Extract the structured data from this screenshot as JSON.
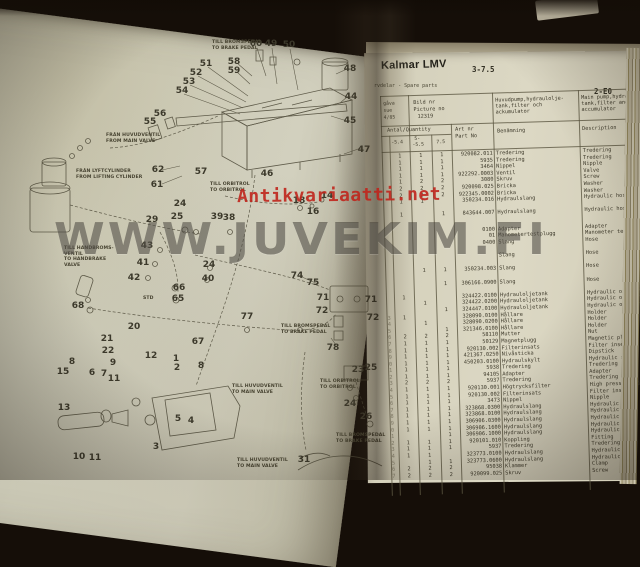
{
  "photo": {
    "watermark": "WWW.JUVEKIM.FI",
    "stamp": "Antikvariaatti.net"
  },
  "colors": {
    "stamp_red": "#c0251c",
    "watermark_gray": "rgba(60,55,48,0.52)",
    "paper_left": "#cccab7",
    "paper_right": "#dcd8c4",
    "table_line": "#5b5641",
    "ink": "#3e3a2b"
  },
  "right_page": {
    "brand": "Kalmar LMV",
    "model_range": "3-7.5",
    "section_code": "2-E0",
    "subtitle": "rvdelar - Spare parts",
    "issue": {
      "l1": "gåva",
      "l2": "sue",
      "l3": "4/85"
    },
    "picture": {
      "l1": "Bild nr",
      "l2": "Picture no",
      "l3": "12319"
    },
    "title_sv": {
      "l1": "Huvudpump,hydraulolje-",
      "l2": "tank,filter och",
      "l3": "ackumulator"
    },
    "title_en": {
      "l1": "Main pump,hydraulic oil-",
      "l2": "tank,filter and",
      "l3": "accumulator"
    },
    "columns": {
      "qty": "Antal/Quantity",
      "sub1": "-5.4",
      "sub2a": "5-",
      "sub2b": "-5.5",
      "sub3": "7.5",
      "part1": "Art nr",
      "part2": "Part No",
      "name": "Benämning",
      "desc": "Description"
    },
    "rows": [
      {
        "pos": "",
        "q1": "1",
        "q2": "1",
        "q3": "1",
        "part": "920082.011",
        "name": "Tredering",
        "desc": "Tredering",
        "gap": 0
      },
      {
        "pos": "",
        "q1": "1",
        "q2": "1",
        "q3": "1",
        "part": "5935",
        "name": "Tredering",
        "desc": "Tredering",
        "gap": 0
      },
      {
        "pos": "",
        "q1": "1",
        "q2": "1",
        "q3": "1",
        "part": "3464",
        "name": "Nippel",
        "desc": "Nipple",
        "gap": 0
      },
      {
        "pos": "",
        "q1": "1",
        "q2": "1",
        "q3": "1",
        "part": "922292.0003",
        "name": "Ventil",
        "desc": "Valve",
        "gap": 0
      },
      {
        "pos": "",
        "q1": "1",
        "q2": "2",
        "q3": "2",
        "part": "3080",
        "name": "Skruv",
        "desc": "Screw",
        "gap": 0
      },
      {
        "pos": "",
        "q1": "2",
        "q2": "2",
        "q3": "2",
        "part": "920098.025",
        "name": "Bricka",
        "desc": "Washer",
        "gap": 0
      },
      {
        "pos": "",
        "q1": "2",
        "q2": "2",
        "q3": "2",
        "part": "922345.0002",
        "name": "Bricka",
        "desc": "Washer",
        "gap": 0
      },
      {
        "pos": "",
        "q1": "1",
        "q2": "1",
        "q3": "",
        "part": "350234.016",
        "name": "Hydraulslang",
        "desc": "Hydraulic hose",
        "gap": 0
      },
      {
        "pos": "",
        "q1": "1",
        "q2": "",
        "q3": "1",
        "part": "843644.007",
        "name": "Hydraulslang",
        "desc": "Hydraulic hose",
        "gap": 1
      },
      {
        "pos": "",
        "q1": "",
        "q2": "",
        "q3": "",
        "part": "0100",
        "name": "Adapter",
        "desc": "Adapter",
        "gap": 1.5
      },
      {
        "pos": "",
        "q1": "",
        "q2": "",
        "q3": "",
        "part": "01",
        "name": "Manometertestplugg",
        "desc": "Manometer test plug",
        "gap": 0
      },
      {
        "pos": "",
        "q1": "",
        "q2": "",
        "q3": "",
        "part": "0400",
        "name": "Slang",
        "desc": "Hose",
        "gap": 0
      },
      {
        "pos": "",
        "q1": "",
        "q2": "",
        "q3": "",
        "part": "",
        "name": "Slang",
        "desc": "Hose",
        "gap": 1
      },
      {
        "pos": "",
        "q1": "",
        "q2": "1",
        "q3": "1",
        "part": "350234.003",
        "name": "Slang",
        "desc": "Hose",
        "gap": 1
      },
      {
        "pos": "",
        "q1": "",
        "q2": "",
        "q3": "1",
        "part": "306166.0900",
        "name": "Slang",
        "desc": "Hose",
        "gap": 1
      },
      {
        "pos": "",
        "q1": "1",
        "q2": "",
        "q3": "",
        "part": "324422.0100",
        "name": "Hydrauloljetank",
        "desc": "Hydraulic oil tank",
        "gap": 1
      },
      {
        "pos": "",
        "q1": "",
        "q2": "1",
        "q3": "",
        "part": "324422.0200",
        "name": "Hydrauloljetank",
        "desc": "Hydraulic oil tank",
        "gap": 0
      },
      {
        "pos": "",
        "q1": "",
        "q2": "",
        "q3": "1",
        "part": "324447.0100",
        "name": "Hydrauloljetank",
        "desc": "Hydraulic oil tank",
        "gap": 0
      },
      {
        "pos": "3",
        "q1": "1",
        "q2": "",
        "q3": "",
        "part": "328090.0100",
        "name": "Hållare",
        "desc": "Holder",
        "gap": 0
      },
      {
        "pos": "4",
        "q1": "",
        "q2": "1",
        "q3": "",
        "part": "328090.0200",
        "name": "Hållare",
        "desc": "Holder",
        "gap": 0
      },
      {
        "pos": "5",
        "q1": "",
        "q2": "",
        "q3": "1",
        "part": "321346.0100",
        "name": "Hållare",
        "desc": "Holder",
        "gap": 0
      },
      {
        "pos": "6",
        "q1": "2",
        "q2": "2",
        "q3": "2",
        "part": "58110",
        "name": "Mutter",
        "desc": "Nut",
        "gap": 0
      },
      {
        "pos": "7",
        "q1": "1",
        "q2": "1",
        "q3": "1",
        "part": "50129",
        "name": "Magnetplugg",
        "desc": "Magnetic plug",
        "gap": 0
      },
      {
        "pos": "8",
        "q1": "1",
        "q2": "1",
        "q3": "1",
        "part": "920130.002",
        "name": "Filterinsats",
        "desc": "Filter insert",
        "gap": 0
      },
      {
        "pos": "9",
        "q1": "1",
        "q2": "1",
        "q3": "1",
        "part": "421367.0250",
        "name": "Nivåsticka",
        "desc": "Dipstick",
        "gap": 0
      },
      {
        "pos": "0",
        "q1": "1",
        "q2": "1",
        "q3": "1",
        "part": "450203.0100",
        "name": "Hydraulskylt",
        "desc": "Hydraulic sign",
        "gap": 0
      },
      {
        "pos": "1",
        "q1": "1",
        "q2": "1",
        "q3": "1",
        "part": "5938",
        "name": "Tredering",
        "desc": "Tredering",
        "gap": 0
      },
      {
        "pos": "2",
        "q1": "1",
        "q2": "1",
        "q3": "1",
        "part": "94105",
        "name": "Adapter",
        "desc": "Adapter",
        "gap": 0
      },
      {
        "pos": "3",
        "q1": "2",
        "q2": "2",
        "q3": "2",
        "part": "5937",
        "name": "Tredering",
        "desc": "Tredering",
        "gap": 0
      },
      {
        "pos": "4",
        "q1": "1",
        "q2": "1",
        "q3": "1",
        "part": "920130.001",
        "name": "Högtrycksfilter",
        "desc": "High pressure filter",
        "gap": 0
      },
      {
        "pos": "5",
        "q1": "1",
        "q2": "1",
        "q3": "1",
        "part": "920130.002",
        "name": "Filterinsats",
        "desc": "Filter insert",
        "gap": 0
      },
      {
        "pos": "6",
        "q1": "1",
        "q2": "1",
        "q3": "1",
        "part": "3473",
        "name": "Nippel",
        "desc": "Nipple",
        "gap": 0
      },
      {
        "pos": "7",
        "q1": "1",
        "q2": "1",
        "q3": "1",
        "part": "323868.0300",
        "name": "Hydraulslang",
        "desc": "Hydraulic hose",
        "gap": 0
      },
      {
        "pos": "8",
        "q1": "1",
        "q2": "1",
        "q3": "1",
        "part": "323868.0100",
        "name": "Hydraulslang",
        "desc": "Hydraulic hose",
        "gap": 0
      },
      {
        "pos": "9",
        "q1": "1",
        "q2": "1",
        "q3": "1",
        "part": "306906.0300",
        "name": "Hydraulslang",
        "desc": "Hydraulic hose",
        "gap": 0
      },
      {
        "pos": "0",
        "q1": "1",
        "q2": "1",
        "q3": "1",
        "part": "306906.1600",
        "name": "Hydraulslang",
        "desc": "Hydraulic hose",
        "gap": 0
      },
      {
        "pos": "1",
        "q1": "",
        "q2": "",
        "q3": "1",
        "part": "306906.1000",
        "name": "Hydraulslang",
        "desc": "Hydraulic hose",
        "gap": 0
      },
      {
        "pos": "2",
        "q1": "1",
        "q2": "1",
        "q3": "1",
        "part": "920101.010",
        "name": "Koppling",
        "desc": "Fitting",
        "gap": 0
      },
      {
        "pos": "3",
        "q1": "1",
        "q2": "1",
        "q3": "1",
        "part": "5937",
        "name": "Tredering",
        "desc": "Tredering",
        "gap": 0
      },
      {
        "pos": "4",
        "q1": "1",
        "q2": "1",
        "q3": "",
        "part": "323773.0100",
        "name": "Hydraulslang",
        "desc": "Hydraulic hose",
        "gap": 0
      },
      {
        "pos": "5",
        "q1": "",
        "q2": "1",
        "q3": "1",
        "part": "323773.0600",
        "name": "Hydraulslang",
        "desc": "Hydraulic hose",
        "gap": 0
      },
      {
        "pos": "6",
        "q1": "2",
        "q2": "2",
        "q3": "2",
        "part": "95038",
        "name": "Klammer",
        "desc": "Clamp",
        "gap": 0
      },
      {
        "pos": "7",
        "q1": "2",
        "q2": "2",
        "q3": "2",
        "part": "920099.025",
        "name": "Skruv",
        "desc": "Screw",
        "gap": 0
      }
    ]
  },
  "left_page": {
    "labels": [
      {
        "n": "60",
        "x": 256,
        "y": 44
      },
      {
        "n": "49",
        "x": 271,
        "y": 44
      },
      {
        "n": "50",
        "x": 289,
        "y": 45
      },
      {
        "n": "58",
        "x": 234,
        "y": 62
      },
      {
        "n": "59",
        "x": 234,
        "y": 71
      },
      {
        "n": "51",
        "x": 206,
        "y": 64
      },
      {
        "n": "52",
        "x": 196,
        "y": 73
      },
      {
        "n": "53",
        "x": 189,
        "y": 82
      },
      {
        "n": "54",
        "x": 182,
        "y": 91
      },
      {
        "n": "48",
        "x": 350,
        "y": 69
      },
      {
        "n": "44",
        "x": 351,
        "y": 97
      },
      {
        "n": "45",
        "x": 350,
        "y": 121
      },
      {
        "n": "47",
        "x": 364,
        "y": 150
      },
      {
        "n": "56",
        "x": 160,
        "y": 114
      },
      {
        "n": "55",
        "x": 150,
        "y": 122
      },
      {
        "n": "62",
        "x": 158,
        "y": 170
      },
      {
        "n": "61",
        "x": 157,
        "y": 185
      },
      {
        "n": "57",
        "x": 201,
        "y": 172
      },
      {
        "n": "46",
        "x": 267,
        "y": 174
      },
      {
        "n": "18",
        "x": 299,
        "y": 201
      },
      {
        "n": "14",
        "x": 327,
        "y": 196
      },
      {
        "n": "16",
        "x": 313,
        "y": 212
      },
      {
        "n": "24",
        "x": 180,
        "y": 204
      },
      {
        "n": "25",
        "x": 177,
        "y": 217
      },
      {
        "n": "39",
        "x": 217,
        "y": 217
      },
      {
        "n": "38",
        "x": 229,
        "y": 218
      },
      {
        "n": "29",
        "x": 152,
        "y": 220
      },
      {
        "n": "43",
        "x": 147,
        "y": 246
      },
      {
        "n": "41",
        "x": 143,
        "y": 263
      },
      {
        "n": "42",
        "x": 134,
        "y": 278
      },
      {
        "n": "24",
        "x": 209,
        "y": 265
      },
      {
        "n": "40",
        "x": 208,
        "y": 279
      },
      {
        "n": "66",
        "x": 179,
        "y": 288
      },
      {
        "n": "65",
        "x": 178,
        "y": 299
      },
      {
        "n": "68",
        "x": 78,
        "y": 306
      },
      {
        "n": "77",
        "x": 247,
        "y": 317
      },
      {
        "n": "20",
        "x": 134,
        "y": 327
      },
      {
        "n": "21",
        "x": 107,
        "y": 339
      },
      {
        "n": "22",
        "x": 108,
        "y": 351
      },
      {
        "n": "9",
        "x": 113,
        "y": 363
      },
      {
        "n": "11",
        "x": 114,
        "y": 379
      },
      {
        "n": "12",
        "x": 151,
        "y": 356
      },
      {
        "n": "67",
        "x": 198,
        "y": 342
      },
      {
        "n": "1",
        "x": 176,
        "y": 359
      },
      {
        "n": "2",
        "x": 177,
        "y": 368
      },
      {
        "n": "8",
        "x": 72,
        "y": 362
      },
      {
        "n": "8",
        "x": 201,
        "y": 366
      },
      {
        "n": "15",
        "x": 63,
        "y": 372
      },
      {
        "n": "6",
        "x": 92,
        "y": 373
      },
      {
        "n": "7",
        "x": 104,
        "y": 374
      },
      {
        "n": "13",
        "x": 64,
        "y": 408
      },
      {
        "n": "10",
        "x": 79,
        "y": 457
      },
      {
        "n": "11",
        "x": 95,
        "y": 458
      },
      {
        "n": "5",
        "x": 178,
        "y": 419
      },
      {
        "n": "4",
        "x": 191,
        "y": 421
      },
      {
        "n": "3",
        "x": 156,
        "y": 447
      },
      {
        "n": "74",
        "x": 297,
        "y": 276
      },
      {
        "n": "75",
        "x": 313,
        "y": 283
      },
      {
        "n": "71",
        "x": 323,
        "y": 298
      },
      {
        "n": "72",
        "x": 322,
        "y": 311
      },
      {
        "n": "71",
        "x": 371,
        "y": 300
      },
      {
        "n": "72",
        "x": 373,
        "y": 318
      },
      {
        "n": "78",
        "x": 333,
        "y": 348
      },
      {
        "n": "23",
        "x": 358,
        "y": 370
      },
      {
        "n": "25",
        "x": 371,
        "y": 368
      },
      {
        "n": "24",
        "x": 350,
        "y": 404
      },
      {
        "n": "26",
        "x": 366,
        "y": 417
      },
      {
        "n": "31",
        "x": 304,
        "y": 460
      }
    ],
    "callouts": [
      {
        "x": 212,
        "y": 40,
        "lines": [
          "TILL BROMSPEDAL",
          "TO BRAKE PEDAL"
        ]
      },
      {
        "x": 106,
        "y": 133,
        "lines": [
          "FRÅN HUVUDVENTIL",
          "FROM MAIN VALVE"
        ]
      },
      {
        "x": 76,
        "y": 169,
        "lines": [
          "FRÅN LYFTCYLINDER",
          "FROM LIFTING CYLINDER"
        ]
      },
      {
        "x": 210,
        "y": 182,
        "lines": [
          "TILL ORBITROL",
          "TO ORBITROL"
        ]
      },
      {
        "x": 64,
        "y": 246,
        "lines": [
          "TILL HANDBROMS-",
          "VENTIL",
          "TO HANDBRAKE",
          "VALVE"
        ]
      },
      {
        "x": 143,
        "y": 296,
        "lines": [
          "STD"
        ]
      },
      {
        "x": 281,
        "y": 324,
        "lines": [
          "TILL BROMSPEDAL",
          "TO BRAKE PEDAL"
        ]
      },
      {
        "x": 320,
        "y": 379,
        "lines": [
          "TILL ORBITROL",
          "TO ORBITROL"
        ]
      },
      {
        "x": 232,
        "y": 384,
        "lines": [
          "TILL HUVUDVENTIL",
          "TO MAIN VALVE"
        ]
      },
      {
        "x": 336,
        "y": 433,
        "lines": [
          "TILL BROMSPEDAL",
          "TO BRAKE PEDAL"
        ]
      },
      {
        "x": 237,
        "y": 458,
        "lines": [
          "TILL HUVUDVENTIL",
          "TO MAIN VALVE"
        ]
      }
    ]
  }
}
